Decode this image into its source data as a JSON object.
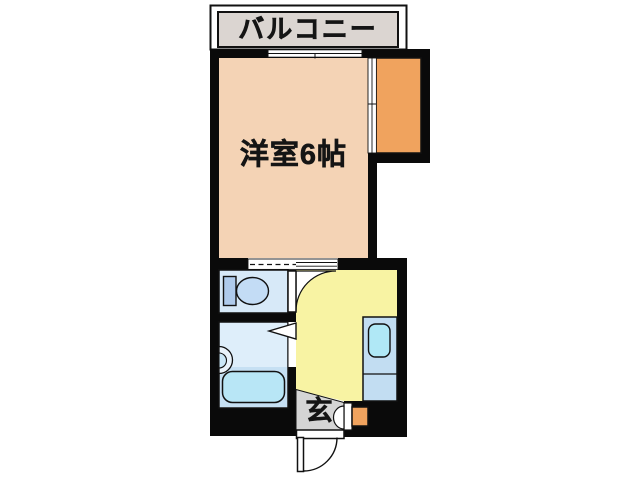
{
  "floorplan": {
    "labels": {
      "balcony": "バルコニー",
      "main_room": "洋室6帖",
      "entrance": "玄"
    },
    "colors": {
      "wall": "#0a0a0a",
      "outline": "#111111",
      "balcony": "#dbd5d1",
      "main_room": "#f4d3b5",
      "closet": "#f0a35e",
      "shoe_cabinet": "#f0a35e",
      "kitchen": "#f8f3a3",
      "toilet_room": "#d7e9f8",
      "bathroom": "#deeefa",
      "bath_platform": "#c6e0f3",
      "bathtub": "#b8e6f6",
      "kitchen_sink": "#b0e8f6",
      "sink_unit": "#c2ddf2",
      "toilet_tank": "#afcbec",
      "toilet_bowl": "#c3dcf5",
      "basin_outer": "#eaf3fb",
      "basin_inner": "#cbe7f7",
      "genkan": "#d5d5d5",
      "opening_white": "#ffffff"
    },
    "icons": {
      "toilet": "toilet-icon",
      "bathtub": "bathtub-icon",
      "washbasin": "washbasin-icon",
      "kitchen_sink": "kitchen-sink-icon",
      "window": "window-icon",
      "doors": "door-swing-icon"
    }
  }
}
